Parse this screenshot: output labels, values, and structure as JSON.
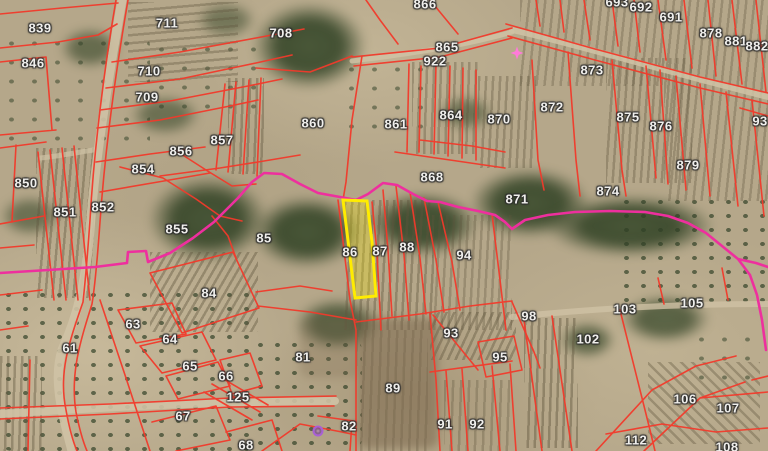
{
  "map": {
    "description": "Aerial cadastral parcel map: red parcel boundaries with white parcel numbers, magenta zone boundary line, parcel 86 highlighted with yellow outline",
    "colors": {
      "parcel_line": "#f23a2b",
      "zone_line": "#ee2f9e",
      "selected_outline": "#ffec00",
      "label_text": "#f0efec",
      "road": "#cfc2a5"
    },
    "selected_parcel": {
      "number": "86"
    },
    "markers": [
      {
        "name": "pink-node-marker",
        "shape": "star",
        "x": 517,
        "y": 53,
        "color": "#ff7ad9"
      },
      {
        "name": "purple-point-marker",
        "shape": "circle",
        "x": 318,
        "y": 431,
        "color": "#a85fd6"
      }
    ],
    "parcel_labels": [
      {
        "n": "839",
        "x": 40,
        "y": 28
      },
      {
        "n": "846",
        "x": 33,
        "y": 63
      },
      {
        "n": "711",
        "x": 167,
        "y": 23
      },
      {
        "n": "710",
        "x": 149,
        "y": 71
      },
      {
        "n": "709",
        "x": 147,
        "y": 97
      },
      {
        "n": "708",
        "x": 281,
        "y": 33
      },
      {
        "n": "866",
        "x": 425,
        "y": 4
      },
      {
        "n": "865",
        "x": 447,
        "y": 47
      },
      {
        "n": "922",
        "x": 435,
        "y": 61
      },
      {
        "n": "693",
        "x": 617,
        "y": 2
      },
      {
        "n": "692",
        "x": 641,
        "y": 7
      },
      {
        "n": "691",
        "x": 671,
        "y": 17
      },
      {
        "n": "878",
        "x": 711,
        "y": 33
      },
      {
        "n": "881",
        "x": 736,
        "y": 41
      },
      {
        "n": "882",
        "x": 757,
        "y": 46
      },
      {
        "n": "873",
        "x": 592,
        "y": 70
      },
      {
        "n": "872",
        "x": 552,
        "y": 107
      },
      {
        "n": "875",
        "x": 628,
        "y": 117
      },
      {
        "n": "876",
        "x": 661,
        "y": 126
      },
      {
        "n": "93",
        "x": 760,
        "y": 121
      },
      {
        "n": "879",
        "x": 688,
        "y": 165
      },
      {
        "n": "874",
        "x": 608,
        "y": 191
      },
      {
        "n": "871",
        "x": 517,
        "y": 199
      },
      {
        "n": "864",
        "x": 451,
        "y": 115
      },
      {
        "n": "870",
        "x": 499,
        "y": 119
      },
      {
        "n": "860",
        "x": 313,
        "y": 123
      },
      {
        "n": "861",
        "x": 396,
        "y": 124
      },
      {
        "n": "868",
        "x": 432,
        "y": 177
      },
      {
        "n": "857",
        "x": 222,
        "y": 140
      },
      {
        "n": "856",
        "x": 181,
        "y": 151
      },
      {
        "n": "850",
        "x": 26,
        "y": 183
      },
      {
        "n": "851",
        "x": 65,
        "y": 212
      },
      {
        "n": "852",
        "x": 103,
        "y": 207
      },
      {
        "n": "854",
        "x": 143,
        "y": 169
      },
      {
        "n": "855",
        "x": 177,
        "y": 229
      },
      {
        "n": "85",
        "x": 264,
        "y": 238
      },
      {
        "n": "84",
        "x": 209,
        "y": 293
      },
      {
        "n": "86",
        "x": 350,
        "y": 252
      },
      {
        "n": "87",
        "x": 380,
        "y": 251
      },
      {
        "n": "88",
        "x": 407,
        "y": 247
      },
      {
        "n": "94",
        "x": 464,
        "y": 255
      },
      {
        "n": "61",
        "x": 70,
        "y": 348
      },
      {
        "n": "63",
        "x": 133,
        "y": 324
      },
      {
        "n": "64",
        "x": 170,
        "y": 339
      },
      {
        "n": "65",
        "x": 190,
        "y": 366
      },
      {
        "n": "66",
        "x": 226,
        "y": 376
      },
      {
        "n": "125",
        "x": 238,
        "y": 397
      },
      {
        "n": "67",
        "x": 183,
        "y": 416
      },
      {
        "n": "68",
        "x": 246,
        "y": 445
      },
      {
        "n": "81",
        "x": 303,
        "y": 357
      },
      {
        "n": "82",
        "x": 349,
        "y": 426
      },
      {
        "n": "89",
        "x": 393,
        "y": 388
      },
      {
        "n": "91",
        "x": 445,
        "y": 424
      },
      {
        "n": "92",
        "x": 477,
        "y": 424
      },
      {
        "n": "93",
        "x": 451,
        "y": 333
      },
      {
        "n": "95",
        "x": 500,
        "y": 357
      },
      {
        "n": "98",
        "x": 529,
        "y": 316
      },
      {
        "n": "102",
        "x": 588,
        "y": 339
      },
      {
        "n": "103",
        "x": 625,
        "y": 309
      },
      {
        "n": "105",
        "x": 692,
        "y": 303
      },
      {
        "n": "106",
        "x": 685,
        "y": 399
      },
      {
        "n": "107",
        "x": 728,
        "y": 408
      },
      {
        "n": "112",
        "x": 636,
        "y": 440
      },
      {
        "n": "108",
        "x": 727,
        "y": 447
      }
    ]
  }
}
